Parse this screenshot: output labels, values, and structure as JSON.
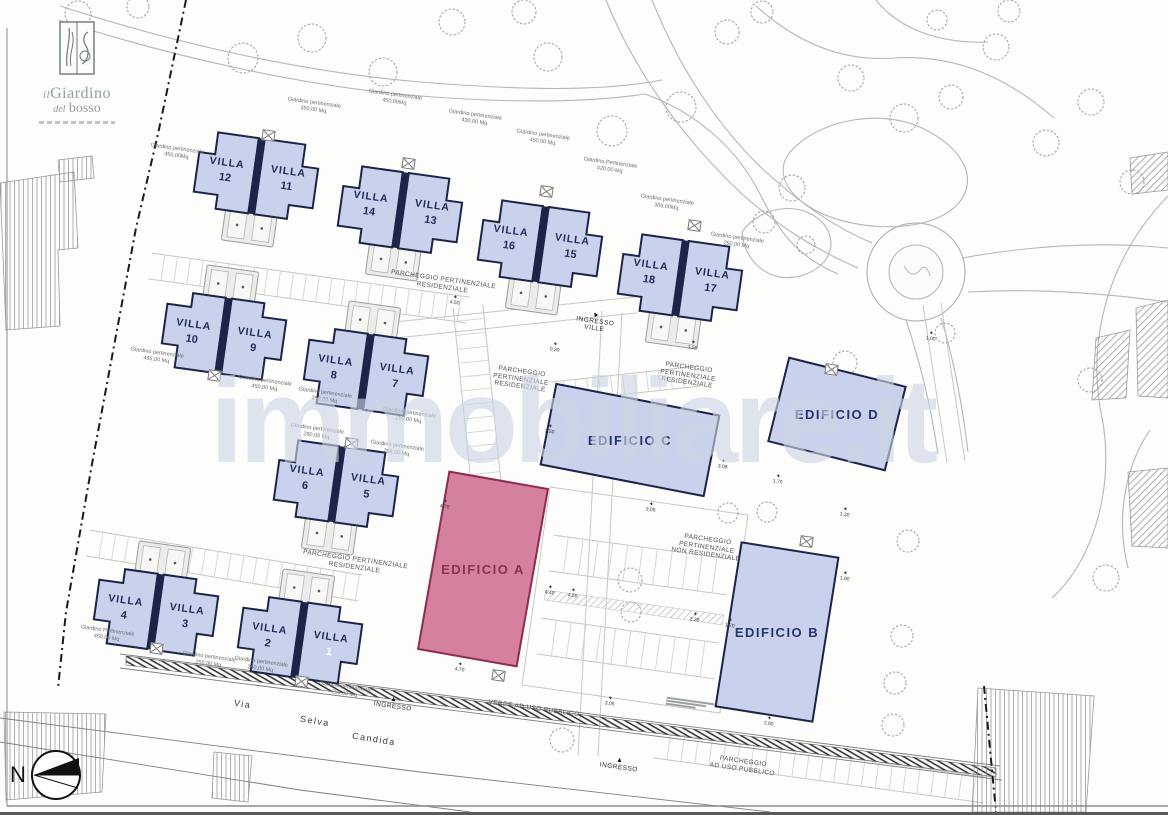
{
  "logo": {
    "prefix": "il",
    "name": "Giardino",
    "prefix2": "del",
    "name2": "bosso"
  },
  "watermark": {
    "text": "immobiliare.it"
  },
  "north": {
    "label": "N"
  },
  "road": {
    "words": [
      {
        "text": "Via",
        "x": 234,
        "y": 699
      },
      {
        "text": "Selva",
        "x": 300,
        "y": 716
      },
      {
        "text": "Candida",
        "x": 352,
        "y": 734
      }
    ]
  },
  "villas": {
    "unit_word": "VILLA",
    "pairs": [
      {
        "id": "pair-12-11",
        "left_num": "12",
        "right_num": "11",
        "x": 194,
        "y": 138,
        "rot": 8,
        "flip": false
      },
      {
        "id": "pair-14-13",
        "left_num": "14",
        "right_num": "13",
        "x": 338,
        "y": 172,
        "rot": 8,
        "flip": false
      },
      {
        "id": "pair-16-15",
        "left_num": "16",
        "right_num": "15",
        "x": 478,
        "y": 206,
        "rot": 8,
        "flip": false
      },
      {
        "id": "pair-18-17",
        "left_num": "18",
        "right_num": "17",
        "x": 618,
        "y": 240,
        "rot": 8,
        "flip": false
      },
      {
        "id": "pair-10-9",
        "left_num": "10",
        "right_num": "9",
        "x": 166,
        "y": 262,
        "rot": 8,
        "flip": true
      },
      {
        "id": "pair-8-7",
        "left_num": "8",
        "right_num": "7",
        "x": 308,
        "y": 298,
        "rot": 8,
        "flip": true
      },
      {
        "id": "pair-6-5",
        "left_num": "6",
        "right_num": "5",
        "x": 274,
        "y": 446,
        "rot": 8,
        "flip": false
      },
      {
        "id": "pair-4-3",
        "left_num": "4",
        "right_num": "3",
        "x": 98,
        "y": 538,
        "rot": 8,
        "flip": true
      },
      {
        "id": "pair-2-1",
        "left_num": "2",
        "right_num": "1",
        "x": 242,
        "y": 566,
        "rot": 8,
        "flip": true,
        "right_num_color": "#ffffff"
      }
    ]
  },
  "buildings": [
    {
      "id": "edificio-a",
      "label": "EDIFICIO A",
      "x": 432,
      "y": 478,
      "w": 102,
      "h": 182,
      "rot": 10,
      "fill": "#d5809f",
      "stroke": "#8e2f52",
      "text_color": "#8e3055"
    },
    {
      "id": "edificio-b",
      "label": "EDIFICIO B",
      "x": 727,
      "y": 548,
      "w": 100,
      "h": 168,
      "rot": 9,
      "fill": "#c9d1ec",
      "stroke": "#1c2547",
      "text_color": "#26356b"
    },
    {
      "id": "edificio-c",
      "label": "EDIFICIO C",
      "x": 546,
      "y": 398,
      "w": 168,
      "h": 84,
      "rot": 11,
      "fill": "#c9d1ec",
      "stroke": "#1c2547",
      "text_color": "#26356b"
    },
    {
      "id": "edificio-d",
      "label": "EDIFICIO D",
      "x": 776,
      "y": 370,
      "w": 122,
      "h": 88,
      "rot": 14,
      "fill": "#c9d1ec",
      "stroke": "#1c2547",
      "text_color": "#26356b"
    }
  ],
  "garden_labels": [
    {
      "x": 150,
      "y": 146,
      "lines": [
        "Giardino pertinenziale",
        "450,00Mq"
      ]
    },
    {
      "x": 287,
      "y": 100,
      "lines": [
        "Giardino pertinenziale",
        "350,00 Mq"
      ]
    },
    {
      "x": 368,
      "y": 92,
      "lines": [
        "Giardino pertinenziale",
        "450,00Mq"
      ]
    },
    {
      "x": 448,
      "y": 112,
      "lines": [
        "Giardino pertinenziale",
        "430,00 Mq"
      ]
    },
    {
      "x": 516,
      "y": 132,
      "lines": [
        "Giardino pertinenziale",
        "450,00 Mq"
      ]
    },
    {
      "x": 583,
      "y": 160,
      "lines": [
        "Giardino Pertinenziale",
        "420,00 Mq"
      ]
    },
    {
      "x": 640,
      "y": 197,
      "lines": [
        "Giardino pertinenziale",
        "366,00Mq"
      ]
    },
    {
      "x": 710,
      "y": 235,
      "lines": [
        "Giardino pertinenziale",
        "250,00 Mq"
      ]
    },
    {
      "x": 130,
      "y": 350,
      "lines": [
        "Giardino pertinenziale",
        "465,00 Mq"
      ]
    },
    {
      "x": 238,
      "y": 378,
      "lines": [
        "Giardino pertinenziale",
        "450,00 Mq"
      ]
    },
    {
      "x": 298,
      "y": 390,
      "lines": [
        "Giardino pertinenziale",
        "250,00 Mq"
      ]
    },
    {
      "x": 382,
      "y": 410,
      "lines": [
        "Giardino pertinenziale",
        "250,00 Mq"
      ]
    },
    {
      "x": 290,
      "y": 426,
      "lines": [
        "Giardino pertinenziale",
        "280,00 Mq"
      ]
    },
    {
      "x": 370,
      "y": 443,
      "lines": [
        "Giardino pertinenziale",
        "288,00 Mq"
      ]
    },
    {
      "x": 80,
      "y": 628,
      "lines": [
        "Giardino Pertinenziale",
        "450,00 Mq"
      ]
    },
    {
      "x": 182,
      "y": 654,
      "lines": [
        "Giardino pertinenziale",
        "250,00 Mq"
      ]
    },
    {
      "x": 234,
      "y": 659,
      "lines": [
        "Giardino pertinenziale",
        "250,00 Mq"
      ]
    },
    {
      "x": 318,
      "y": 684,
      "lines": [
        "Giardino pertinenziale",
        "250,00 Mq"
      ]
    }
  ],
  "parking_labels": [
    {
      "x": 390,
      "y": 276,
      "lines": [
        "PARCHEGGIO PERTINENZIALE",
        "RESIDENZIALE"
      ]
    },
    {
      "x": 493,
      "y": 368,
      "lines": [
        "PARCHEGGIO",
        "PERTINENZIALE",
        "RESIDENZIALE"
      ]
    },
    {
      "x": 660,
      "y": 364,
      "lines": [
        "PARCHEGGIO",
        "PERTINENZIALE",
        "RESIDENZIALE"
      ]
    },
    {
      "x": 302,
      "y": 556,
      "lines": [
        "PARCHEGGIO PERTINENZIALE",
        "RESIDENZIALE"
      ]
    },
    {
      "x": 672,
      "y": 536,
      "lines": [
        "PARCHEGGIO",
        "PERTINENZIALE",
        "NON RESIDENZIALE"
      ]
    },
    {
      "x": 710,
      "y": 758,
      "lines": [
        "PARCHEGGIO",
        "AD USO PUBBLICO"
      ]
    },
    {
      "x": 488,
      "y": 705,
      "lines": [
        "VERDE AD USO PUBBLICO"
      ]
    }
  ],
  "entrances": [
    {
      "x": 576,
      "y": 312,
      "lines": [
        "INGRESSO",
        "VILLE"
      ],
      "arrow_rot": -40
    },
    {
      "x": 374,
      "y": 697,
      "lines": [
        "INGRESSO"
      ],
      "arrow_rot": 0
    },
    {
      "x": 600,
      "y": 758,
      "lines": [
        "INGRESSO"
      ],
      "arrow_rot": 0
    }
  ],
  "dims": [
    [
      450,
      296,
      "4,50"
    ],
    [
      550,
      343,
      "0,30"
    ],
    [
      688,
      341,
      "1,50"
    ],
    [
      545,
      425,
      "2,50"
    ],
    [
      718,
      460,
      "3,08"
    ],
    [
      773,
      475,
      "1,70"
    ],
    [
      840,
      508,
      "1,30"
    ],
    [
      646,
      503,
      "3,05"
    ],
    [
      440,
      500,
      "4,70"
    ],
    [
      545,
      586,
      "4,40"
    ],
    [
      568,
      589,
      "4,55"
    ],
    [
      690,
      613,
      "2,35"
    ],
    [
      455,
      663,
      "4,70"
    ],
    [
      605,
      697,
      "3,05"
    ],
    [
      725,
      619,
      "1,70"
    ],
    [
      840,
      572,
      "1,90"
    ],
    [
      764,
      717,
      "2,00"
    ],
    [
      926,
      332,
      "1,00"
    ]
  ],
  "colors": {
    "villa_fill": "#c9d1ec",
    "villa_stroke": "#1c2547",
    "villa_text": "#1d2c58",
    "garage_fill": "#ececea",
    "garage_stroke": "#9b9b99",
    "slot_fill": "#f7f7f5",
    "slot_stroke": "#b5b5b3",
    "tree": "#9aa39e",
    "road": "#b4b7b5",
    "band": "#c7c7c5",
    "tick": "#d4d4d2",
    "boundary": "#1a1a1a",
    "frame": "#8a8a8a"
  },
  "geometry": {
    "roads": [
      "M60,6 C170,42 300,72 420,82 C520,90 600,92 662,80",
      "M58,20 C170,56 300,86 420,96 C510,103 585,103 645,94",
      "M645,94 C700,114 740,152 762,198 C780,234 800,258 838,274",
      "M652,0 C676,60 714,124 766,172 C802,205 836,228 872,243",
      "M606,0 C634,70 684,140 742,194 C776,224 812,248 858,268",
      "M962,258 C1040,244 1108,242 1168,248",
      "M968,292 C1040,288 1110,294 1168,302",
      "M906,320 C920,362 930,402 938,454",
      "M941,318 C954,360 962,402 968,452",
      "M756,6 C796,42 842,62 894,58 C956,54 1008,78 1054,118",
      "M876,0 C898,28 938,44 988,42",
      "M1168,196 C1108,258 1086,340 1102,418 C1114,478 1098,556 1052,598",
      "M1150,430 C1124,468 1116,520 1128,568",
      "M790,152 C818,120 880,108 922,128 C962,147 980,178 958,204 C928,236 848,232 808,206 C784,190 776,170 790,152",
      "M742,232 C760,206 800,200 822,222 C840,242 830,268 800,276 C770,284 744,262 742,232"
    ],
    "roundabout": {
      "cx": 916,
      "cy": 272,
      "r_outer": 49,
      "r_inner": 27
    },
    "boundary": [
      "M186,0 L158,134 L136,228 L92,464 L66,612 L58,688",
      "M984,686 L996,812"
    ],
    "road_band": "126,656 996,768 996,777 126,665",
    "road_lines": [
      "M120,654 L1000,766",
      "M120,668 L1002,780",
      "M0,718 L420,772 L770,812",
      "M0,742 L300,790 L470,812"
    ],
    "hatch_buildings": [
      {
        "pts": "0,183 74,172 78,248 58,250 60,326 6,330",
        "p": "hv"
      },
      {
        "pts": "58,160 92,156 94,178 60,182",
        "p": "hv"
      },
      {
        "pts": "4,712 106,714 102,792 6,800",
        "p": "hv"
      },
      {
        "pts": "214,752 252,756 248,802 212,798",
        "p": "hv"
      },
      {
        "pts": "978,688 1094,696 1086,812 972,812",
        "p": "hv"
      },
      {
        "pts": "1096,338 1130,330 1126,398 1092,400",
        "p": "hd"
      },
      {
        "pts": "1136,308 1168,300 1168,398 1138,396",
        "p": "hd"
      },
      {
        "pts": "1130,158 1168,152 1168,190 1132,194",
        "p": "hd"
      },
      {
        "pts": "1128,472 1168,468 1168,548 1132,546",
        "p": "hd"
      }
    ],
    "bands": [
      {
        "x1": 150,
        "y1": 266,
        "x2": 468,
        "y2": 310,
        "w": 26,
        "t": 13
      },
      {
        "x1": 88,
        "y1": 543,
        "x2": 360,
        "y2": 588,
        "w": 26,
        "t": 13
      },
      {
        "x1": 612,
        "y1": 312,
        "x2": 588,
        "y2": 756,
        "w": 20,
        "t": 0
      },
      {
        "x1": 356,
        "y1": 334,
        "x2": 636,
        "y2": 305,
        "w": 16,
        "t": 0
      },
      {
        "x1": 468,
        "y1": 306,
        "x2": 490,
        "y2": 522,
        "w": 30,
        "t": 14
      },
      {
        "x1": 932,
        "y1": 304,
        "x2": 956,
        "y2": 462,
        "w": 18,
        "t": 0
      },
      {
        "x1": 552,
        "y1": 392,
        "x2": 700,
        "y2": 376,
        "w": 20,
        "t": 12
      },
      {
        "x1": 551,
        "y1": 553,
        "x2": 729,
        "y2": 577,
        "w": 36,
        "t": 15
      },
      {
        "x1": 539,
        "y1": 636,
        "x2": 717,
        "y2": 661,
        "w": 36,
        "t": 15
      },
      {
        "x1": 655,
        "y1": 745,
        "x2": 985,
        "y2": 790,
        "w": 26,
        "t": 14
      }
    ],
    "loops": [
      "M550,487 L748,515 L720,713 L522,685 Z"
    ],
    "hatch_bands": [
      {
        "x1": 545,
        "y1": 595,
        "x2": 723,
        "y2": 620,
        "w": 10
      }
    ],
    "trees": [
      [
        78,
        14,
        13
      ],
      [
        138,
        7,
        11
      ],
      [
        243,
        58,
        15
      ],
      [
        312,
        38,
        14
      ],
      [
        383,
        72,
        14
      ],
      [
        452,
        22,
        13
      ],
      [
        524,
        12,
        12
      ],
      [
        548,
        57,
        14
      ],
      [
        612,
        131,
        15
      ],
      [
        681,
        107,
        15
      ],
      [
        727,
        32,
        12
      ],
      [
        762,
        12,
        11
      ],
      [
        792,
        188,
        13
      ],
      [
        764,
        222,
        11
      ],
      [
        851,
        78,
        13
      ],
      [
        904,
        118,
        14
      ],
      [
        951,
        97,
        12
      ],
      [
        996,
        47,
        13
      ],
      [
        1046,
        143,
        13
      ],
      [
        1091,
        102,
        13
      ],
      [
        1132,
        182,
        12
      ],
      [
        937,
        20,
        10
      ],
      [
        1009,
        11,
        11
      ],
      [
        806,
        245,
        9
      ],
      [
        945,
        333,
        10
      ],
      [
        845,
        363,
        12
      ],
      [
        1090,
        380,
        12
      ],
      [
        1106,
        578,
        13
      ],
      [
        908,
        541,
        11
      ],
      [
        902,
        636,
        11
      ],
      [
        895,
        683,
        11
      ],
      [
        893,
        725,
        11
      ],
      [
        630,
        580,
        12
      ],
      [
        631,
        612,
        10
      ],
      [
        728,
        513,
        10
      ],
      [
        767,
        512,
        10
      ],
      [
        562,
        740,
        12
      ]
    ],
    "utility_boxes": [
      [
        262,
        130
      ],
      [
        402,
        158
      ],
      [
        540,
        186
      ],
      [
        688,
        220
      ],
      [
        208,
        370
      ],
      [
        345,
        438
      ],
      [
        150,
        643
      ],
      [
        295,
        676
      ],
      [
        492,
        670
      ],
      [
        800,
        536
      ],
      [
        825,
        364
      ]
    ],
    "micronotes": [
      {
        "x": 666,
        "y": 700,
        "widths": [
          48,
          40,
          30
        ]
      }
    ]
  }
}
